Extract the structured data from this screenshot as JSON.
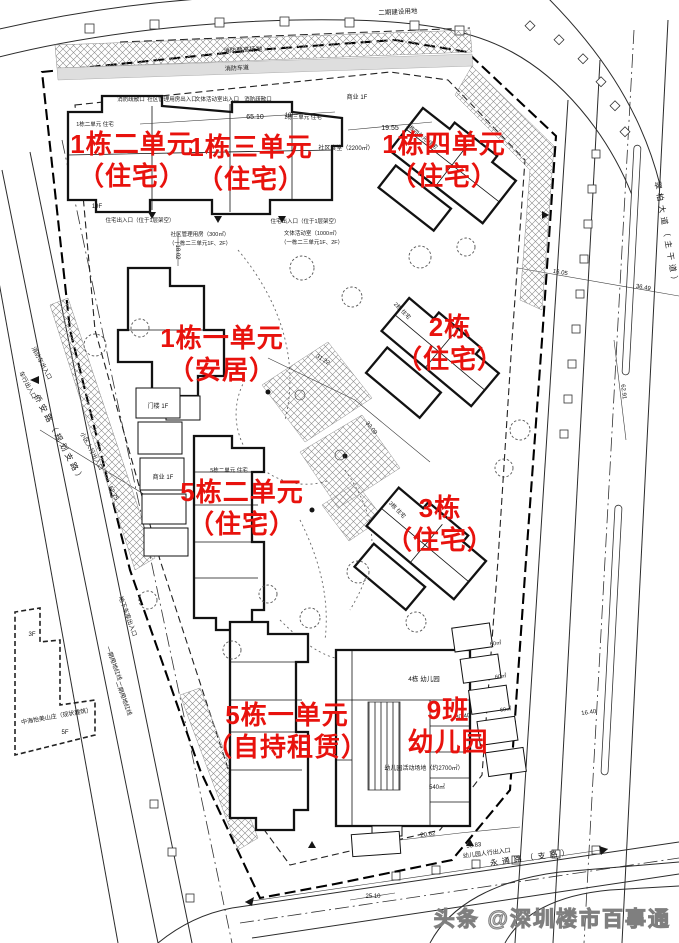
{
  "colors": {
    "label_red": "#e8120d",
    "drawing_line": "#2b2b2b",
    "hatch_gray": "#8c8c8c",
    "watermark_gray": "#7f7f7f"
  },
  "red_labels": [
    {
      "line1": "1栋二单元",
      "line2": "（住宅）"
    },
    {
      "line1": "1栋三单元",
      "line2": "（住宅）"
    },
    {
      "line1": "1栋四单元",
      "line2": "（住宅）"
    },
    {
      "line1": "1栋一单元",
      "line2": "（安居）"
    },
    {
      "line1": "2栋",
      "line2": "（住宅）"
    },
    {
      "line1": "5栋二单元",
      "line2": "（住宅）"
    },
    {
      "line1": "3栋",
      "line2": "（住宅）"
    },
    {
      "line1": "5栋一单元",
      "line2": "（自持租赁）"
    },
    {
      "line1": "9班",
      "line2": "幼儿园"
    }
  ],
  "roads": {
    "right": "翠柏大道（主干道）",
    "bottom": "永通路（支路）",
    "left": "侨安路（规划支路）",
    "top_area": "二期建设用地",
    "existing_building": "中海怡美山庄（现状建筑）"
  },
  "annotations": [
    {
      "text": "65.10"
    },
    {
      "text": "19.55"
    },
    {
      "text": "社区食堂（2200㎡）"
    },
    {
      "text": "消防登高场地"
    },
    {
      "text": "消防车道"
    },
    {
      "text": "消防疏散口"
    },
    {
      "text": "社区管理用房出入口"
    },
    {
      "text": "文体活动室出入口"
    },
    {
      "text": "消防疏散口"
    },
    {
      "text": "住宅出入口（位于1层架空）"
    },
    {
      "text": "住宅出入口（位于1层架空）"
    },
    {
      "text": "社区管理用房（300㎡）"
    },
    {
      "text": "（一栋二三单元1F、2F）"
    },
    {
      "text": "文体活动室（1000㎡）"
    },
    {
      "text": "（一栋二三单元1F、2F）"
    },
    {
      "text": "18.02"
    },
    {
      "text": "商业 1F"
    },
    {
      "text": "19F"
    },
    {
      "text": "19F"
    },
    {
      "text": "31.22"
    },
    {
      "text": "32.09"
    },
    {
      "text": "16.05"
    },
    {
      "text": "36.49"
    },
    {
      "text": "62.91"
    },
    {
      "text": "门楼 1F"
    },
    {
      "text": "商业 1F"
    },
    {
      "text": "小区人行出入口"
    },
    {
      "text": "52.25"
    },
    {
      "text": "车行出入口"
    },
    {
      "text": "消防车出入口"
    },
    {
      "text": "地下车库出入口"
    },
    {
      "text": "一期用地红线"
    },
    {
      "text": "二期用地红线"
    },
    {
      "text": "5F"
    },
    {
      "text": "3F"
    },
    {
      "text": "4栋 幼儿园"
    },
    {
      "text": "幼儿园活动场地（约2700㎡）"
    },
    {
      "text": "540㎡"
    },
    {
      "text": "60㎡"
    },
    {
      "text": "60㎡"
    },
    {
      "text": "60㎡"
    },
    {
      "text": "30.40"
    },
    {
      "text": "16.40"
    },
    {
      "text": "20.62"
    },
    {
      "text": "50.83"
    },
    {
      "text": "幼儿园人行出入口"
    },
    {
      "text": "25.10"
    },
    {
      "text": "1栋二单元 住宅"
    },
    {
      "text": "1栋三单元 住宅"
    },
    {
      "text": "1栋四单元 住宅"
    },
    {
      "text": "2栋 住宅"
    },
    {
      "text": "3栋 住宅"
    },
    {
      "text": "5栋二单元 住宅"
    }
  ],
  "watermark": {
    "text": "头条 @深圳楼市百事通"
  }
}
